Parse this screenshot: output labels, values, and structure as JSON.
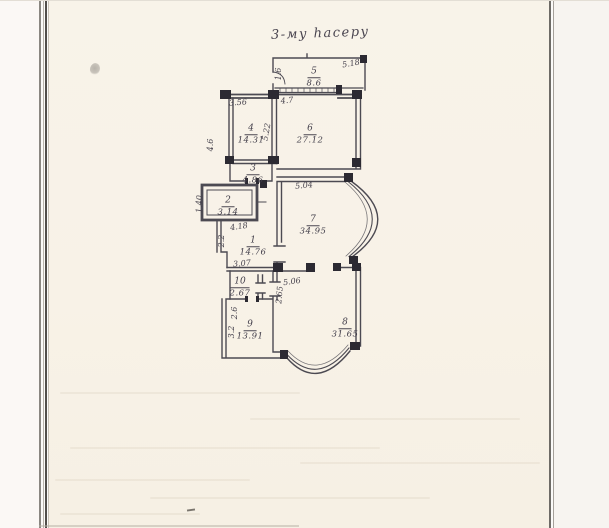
{
  "page": {
    "handwritten_title": "3-му hacepy"
  },
  "plan": {
    "ink_color": "#3e3c46",
    "paper_color": "#f8f3e9",
    "rooms": [
      {
        "number": "5",
        "area": "8.6"
      },
      {
        "number": "4",
        "area": "14.31"
      },
      {
        "number": "6",
        "area": "27.12"
      },
      {
        "number": "3",
        "area": "4.86"
      },
      {
        "number": "2",
        "area": "3.14"
      },
      {
        "number": "1",
        "area": "14.76"
      },
      {
        "number": "7",
        "area": "34.95"
      },
      {
        "number": "10",
        "area": "2.67"
      },
      {
        "number": "9",
        "area": "13.91"
      },
      {
        "number": "8",
        "area": "31.65"
      }
    ],
    "dimensions": [
      {
        "value": "5.18"
      },
      {
        "value": "1.6"
      },
      {
        "value": "4.7"
      },
      {
        "value": "3.56"
      },
      {
        "value": "4.6"
      },
      {
        "value": "5.22"
      },
      {
        "value": "5.04"
      },
      {
        "value": "4.18"
      },
      {
        "value": "1.40"
      },
      {
        "value": "2.2"
      },
      {
        "value": "3.07"
      },
      {
        "value": "5.06"
      },
      {
        "value": "2.65"
      },
      {
        "value": "2.6"
      },
      {
        "value": "3.2"
      }
    ]
  }
}
